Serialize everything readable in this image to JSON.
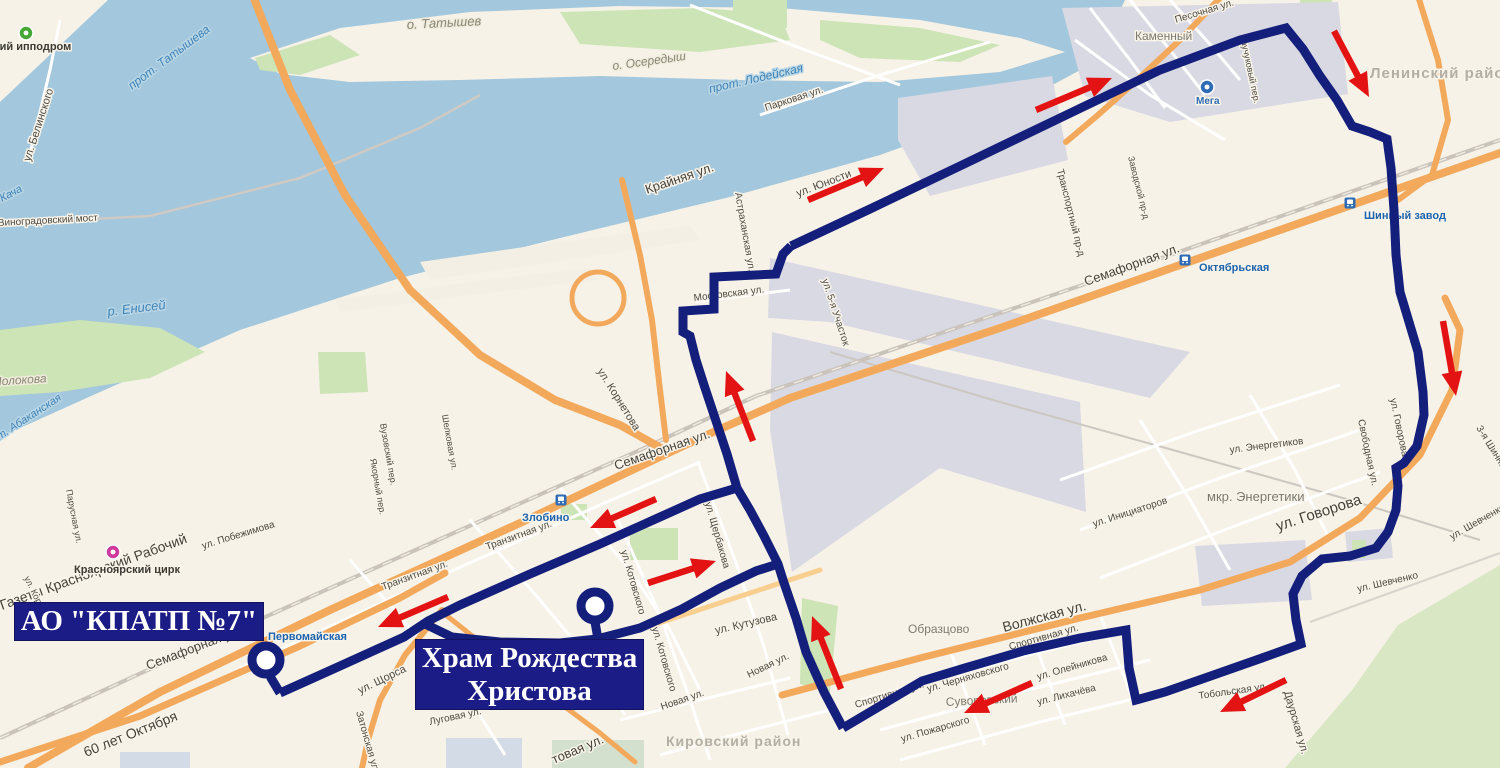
{
  "map": {
    "colors": {
      "background": "#f7f2e8",
      "water": "#a3c7dc",
      "green": "#cde4b6",
      "industrial": "#d9d9e3",
      "main_road": "#f3a95c",
      "route": "#141f7b",
      "arrow": "#e31313",
      "callout_bg": "#1c1c87",
      "station_blue": "#2e6cb6"
    },
    "callouts": [
      {
        "id": "depot",
        "text": "АО \"КПАТП №7\""
      },
      {
        "id": "khram",
        "lines": [
          "Храм Рождества",
          "Христова"
        ]
      }
    ],
    "terminals": [
      {
        "name": "АО КПАТП №7",
        "x": 266,
        "y": 660
      },
      {
        "name": "Храм Рождества Христова",
        "x": 595,
        "y": 606
      }
    ],
    "route": {
      "width": 9,
      "segments": [
        [
          [
            267,
            661
          ],
          [
            271,
            678
          ],
          [
            280,
            693
          ]
        ],
        [
          [
            280,
            693
          ],
          [
            340,
            666
          ],
          [
            404,
            637
          ],
          [
            428,
            621
          ],
          [
            460,
            605
          ],
          [
            530,
            574
          ],
          [
            600,
            544
          ],
          [
            660,
            517
          ],
          [
            700,
            499
          ],
          [
            737,
            488
          ]
        ],
        [
          [
            425,
            624
          ],
          [
            452,
            637
          ],
          [
            500,
            642
          ],
          [
            560,
            643
          ],
          [
            597,
            639
          ],
          [
            640,
            628
          ],
          [
            682,
            609
          ],
          [
            720,
            588
          ],
          [
            756,
            571
          ],
          [
            778,
            564
          ]
        ],
        [
          [
            595,
            622
          ],
          [
            598,
            639
          ]
        ],
        [
          [
            843,
            728
          ],
          [
            824,
            692
          ],
          [
            806,
            652
          ],
          [
            796,
            618
          ],
          [
            783,
            580
          ],
          [
            778,
            564
          ],
          [
            764,
            536
          ],
          [
            750,
            510
          ],
          [
            737,
            488
          ],
          [
            727,
            454
          ],
          [
            716,
            421
          ],
          [
            705,
            388
          ],
          [
            696,
            360
          ],
          [
            690,
            336
          ],
          [
            683,
            332
          ],
          [
            683,
            311
          ],
          [
            714,
            309
          ],
          [
            714,
            277
          ],
          [
            776,
            274
          ],
          [
            783,
            254
          ],
          [
            791,
            246
          ]
        ],
        [
          [
            791,
            246
          ],
          [
            870,
            209
          ],
          [
            960,
            166
          ],
          [
            1060,
            118
          ],
          [
            1160,
            70
          ],
          [
            1240,
            40
          ],
          [
            1286,
            28
          ],
          [
            1303,
            49
          ],
          [
            1320,
            76
          ],
          [
            1337,
            100
          ],
          [
            1352,
            126
          ],
          [
            1370,
            132
          ],
          [
            1387,
            139
          ],
          [
            1391,
            168
          ],
          [
            1394,
            210
          ],
          [
            1396,
            255
          ],
          [
            1400,
            292
          ],
          [
            1409,
            322
          ],
          [
            1418,
            352
          ],
          [
            1423,
            392
          ],
          [
            1424,
            415
          ],
          [
            1417,
            446
          ],
          [
            1404,
            463
          ],
          [
            1396,
            468
          ],
          [
            1398,
            486
          ],
          [
            1396,
            510
          ],
          [
            1388,
            532
          ],
          [
            1376,
            548
          ],
          [
            1350,
            556
          ],
          [
            1322,
            559
          ],
          [
            1302,
            576
          ],
          [
            1293,
            594
          ],
          [
            1296,
            620
          ],
          [
            1301,
            644
          ],
          [
            1262,
            658
          ],
          [
            1205,
            678
          ],
          [
            1165,
            692
          ],
          [
            1136,
            700
          ],
          [
            1129,
            668
          ],
          [
            1126,
            630
          ],
          [
            1080,
            638
          ],
          [
            1023,
            651
          ],
          [
            965,
            668
          ],
          [
            922,
            681
          ],
          [
            870,
            712
          ],
          [
            843,
            728
          ]
        ]
      ]
    },
    "arrows": [
      [
        808,
        200,
        884,
        168
      ],
      [
        1036,
        110,
        1112,
        78
      ],
      [
        1334,
        31,
        1369,
        97
      ],
      [
        1443,
        321,
        1456,
        396
      ],
      [
        753,
        441,
        726,
        371
      ],
      [
        841,
        689,
        812,
        616
      ],
      [
        656,
        499,
        590,
        528
      ],
      [
        448,
        597,
        378,
        627
      ],
      [
        648,
        583,
        716,
        561
      ],
      [
        1032,
        683,
        964,
        713
      ],
      [
        1286,
        680,
        1220,
        712
      ]
    ],
    "stations": [
      {
        "name": "Первомайская",
        "x": 254,
        "y": 628,
        "tx": 268,
        "ty": 640
      },
      {
        "name": "Злобино",
        "x": 561,
        "y": 500,
        "tx": 522,
        "ty": 521
      },
      {
        "name": "Октябрьская",
        "x": 1185,
        "y": 260,
        "tx": 1199,
        "ty": 271
      },
      {
        "name": "Шинный завод",
        "x": 1350,
        "y": 203,
        "tx": 1364,
        "ty": 219
      }
    ],
    "pois": [
      {
        "name": "ипподром",
        "x": 26,
        "y": 33,
        "color": "#45a836"
      },
      {
        "name": "цирк",
        "x": 113,
        "y": 552,
        "color": "#cf3a9b"
      },
      {
        "name": "Мега",
        "x": 1207,
        "y": 87,
        "color": "#2e6cb6"
      }
    ],
    "labels": [
      {
        "t": "Красноярский ипподром",
        "x": -64,
        "y": 50,
        "r": 0,
        "s": 11,
        "c": "poi"
      },
      {
        "t": "ул. Белинского",
        "x": 30,
        "y": 162,
        "r": -72,
        "s": 11,
        "c": "st"
      },
      {
        "t": "прот. Татышева",
        "x": 132,
        "y": 90,
        "r": -37,
        "s": 12,
        "c": "w"
      },
      {
        "t": "о. Татышев",
        "x": 407,
        "y": 29,
        "r": -3,
        "s": 13,
        "c": "li"
      },
      {
        "t": "о. Осередыш",
        "x": 613,
        "y": 70,
        "r": -8,
        "s": 12,
        "c": "li"
      },
      {
        "t": "прот. Лодейская",
        "x": 710,
        "y": 93,
        "r": -13,
        "s": 12,
        "c": "w"
      },
      {
        "t": "Парковая ул.",
        "x": 766,
        "y": 111,
        "r": -18,
        "s": 10,
        "c": "st"
      },
      {
        "t": "Крайняя ул.",
        "x": 647,
        "y": 194,
        "r": -19,
        "s": 13,
        "c": "stb"
      },
      {
        "t": "Астраханская ул.",
        "x": 735,
        "y": 193,
        "r": 80,
        "s": 10,
        "c": "st"
      },
      {
        "t": "ул. Юности",
        "x": 798,
        "y": 197,
        "r": -21,
        "s": 11,
        "c": "st"
      },
      {
        "t": "Песочная ул.",
        "x": 1176,
        "y": 23,
        "r": -17,
        "s": 10,
        "c": "st"
      },
      {
        "t": "Каменный",
        "x": 1135,
        "y": 40,
        "r": 0,
        "s": 12,
        "c": "d"
      },
      {
        "t": "Мега",
        "x": 1196,
        "y": 104,
        "r": 0,
        "s": 10,
        "c": "mega"
      },
      {
        "t": "Каучуковый пер.",
        "x": 1240,
        "y": 36,
        "r": 78,
        "s": 9,
        "c": "st"
      },
      {
        "t": "Ленинский район",
        "x": 1370,
        "y": 78,
        "r": 0,
        "s": 15,
        "c": "db"
      },
      {
        "t": "Транспортный пр-д",
        "x": 1057,
        "y": 170,
        "r": 76,
        "s": 10,
        "c": "st"
      },
      {
        "t": "Заводской пр-д",
        "x": 1128,
        "y": 157,
        "r": 76,
        "s": 9,
        "c": "st"
      },
      {
        "t": "Семафорная ул.",
        "x": 1086,
        "y": 286,
        "r": -20,
        "s": 13,
        "c": "stb"
      },
      {
        "t": "Московская ул.",
        "x": 694,
        "y": 301,
        "r": -7,
        "s": 10,
        "c": "st"
      },
      {
        "t": "ул. 5-я Участок",
        "x": 822,
        "y": 280,
        "r": 72,
        "s": 10,
        "c": "st"
      },
      {
        "t": "ул. Корнетова",
        "x": 597,
        "y": 371,
        "r": 58,
        "s": 11,
        "c": "st"
      },
      {
        "t": "Семафорная ул.",
        "x": 616,
        "y": 470,
        "r": -19,
        "s": 13,
        "c": "stb"
      },
      {
        "t": "р. Енисей",
        "x": 108,
        "y": 316,
        "r": -7,
        "s": 13,
        "c": "w"
      },
      {
        "t": "Молокова",
        "x": -8,
        "y": 386,
        "r": -4,
        "s": 12,
        "c": "li"
      },
      {
        "t": "прот. Абаканская",
        "x": -16,
        "y": 450,
        "r": -33,
        "s": 11,
        "c": "w"
      },
      {
        "t": "Парусная ул.",
        "x": 66,
        "y": 490,
        "r": 79,
        "s": 9,
        "c": "st"
      },
      {
        "t": "Газеты Красноярский Рабочий",
        "x": 2,
        "y": 610,
        "r": -20,
        "s": 14,
        "c": "stb"
      },
      {
        "t": "ул. Побежимова",
        "x": 203,
        "y": 549,
        "r": -17,
        "s": 10,
        "c": "st"
      },
      {
        "t": "Красноярский цирк",
        "x": 74,
        "y": 573,
        "r": 0,
        "s": 11,
        "c": "poi"
      },
      {
        "t": "ул. Королёва",
        "x": 24,
        "y": 578,
        "r": 64,
        "s": 9,
        "c": "st"
      },
      {
        "t": "Вузовский пер.",
        "x": 380,
        "y": 424,
        "r": 80,
        "s": 9,
        "c": "st"
      },
      {
        "t": "Якорный пер.",
        "x": 370,
        "y": 459,
        "r": 80,
        "s": 9,
        "c": "st"
      },
      {
        "t": "Шелковая ул.",
        "x": 442,
        "y": 415,
        "r": 80,
        "s": 9,
        "c": "st"
      },
      {
        "t": "Семафорная ул.",
        "x": 148,
        "y": 670,
        "r": -21,
        "s": 13,
        "c": "stb"
      },
      {
        "t": "Транзитная ул.",
        "x": 383,
        "y": 590,
        "r": -20,
        "s": 10,
        "c": "st"
      },
      {
        "t": "Транзитная ул.",
        "x": 487,
        "y": 550,
        "r": -20,
        "s": 10,
        "c": "st"
      },
      {
        "t": "ул. Щорса",
        "x": 360,
        "y": 694,
        "r": -26,
        "s": 11,
        "c": "st"
      },
      {
        "t": "Затонская ул.",
        "x": 356,
        "y": 712,
        "r": 74,
        "s": 10,
        "c": "st"
      },
      {
        "t": "60 лет Октября",
        "x": 86,
        "y": 757,
        "r": -22,
        "s": 14,
        "c": "stb"
      },
      {
        "t": "Луговая ул.",
        "x": 430,
        "y": 725,
        "r": -12,
        "s": 10,
        "c": "st"
      },
      {
        "t": "ул. Щербакова",
        "x": 705,
        "y": 503,
        "r": 74,
        "s": 10,
        "c": "st"
      },
      {
        "t": "ул. Котовского",
        "x": 621,
        "y": 551,
        "r": 74,
        "s": 10,
        "c": "st"
      },
      {
        "t": "ул. Котовского",
        "x": 652,
        "y": 628,
        "r": 74,
        "s": 10,
        "c": "st"
      },
      {
        "t": "ул. Кутузова",
        "x": 716,
        "y": 634,
        "r": -13,
        "s": 11,
        "c": "st"
      },
      {
        "t": "Новая ул.",
        "x": 749,
        "y": 678,
        "r": -26,
        "s": 10,
        "c": "st"
      },
      {
        "t": "Новая ул.",
        "x": 662,
        "y": 710,
        "r": -19,
        "s": 10,
        "c": "st"
      },
      {
        "t": "Кировский район",
        "x": 666,
        "y": 746,
        "r": 0,
        "s": 14,
        "c": "db"
      },
      {
        "t": "товая ул.",
        "x": 554,
        "y": 764,
        "r": -23,
        "s": 13,
        "c": "stb"
      },
      {
        "t": "Образцово",
        "x": 908,
        "y": 633,
        "r": 0,
        "s": 12,
        "c": "d"
      },
      {
        "t": "Волжская ул.",
        "x": 1004,
        "y": 632,
        "r": -15,
        "s": 14,
        "c": "stb"
      },
      {
        "t": "Спортивная ул.",
        "x": 1010,
        "y": 650,
        "r": -16,
        "s": 10,
        "c": "st"
      },
      {
        "t": "Спортивная ул.",
        "x": 856,
        "y": 708,
        "r": -17,
        "s": 10,
        "c": "st"
      },
      {
        "t": "ул. Черняховского",
        "x": 928,
        "y": 692,
        "r": -16,
        "s": 10,
        "c": "st"
      },
      {
        "t": "ул. Олейникова",
        "x": 1038,
        "y": 680,
        "r": -16,
        "s": 10,
        "c": "st"
      },
      {
        "t": "ул. Лихачёва",
        "x": 1038,
        "y": 705,
        "r": -14,
        "s": 10,
        "c": "st"
      },
      {
        "t": "ул. Пожарского",
        "x": 902,
        "y": 742,
        "r": -16,
        "s": 10,
        "c": "st"
      },
      {
        "t": "Суворовский",
        "x": 946,
        "y": 706,
        "r": -3,
        "s": 12,
        "c": "d"
      },
      {
        "t": "ул. Инициаторов",
        "x": 1094,
        "y": 527,
        "r": -18,
        "s": 10,
        "c": "st"
      },
      {
        "t": "мкр. Энергетики",
        "x": 1207,
        "y": 501,
        "r": 0,
        "s": 13,
        "c": "d"
      },
      {
        "t": "ул. Энергетиков",
        "x": 1230,
        "y": 453,
        "r": -7,
        "s": 10,
        "c": "st"
      },
      {
        "t": "Свободная ул.",
        "x": 1358,
        "y": 420,
        "r": 78,
        "s": 10,
        "c": "st"
      },
      {
        "t": "ул. Говорова",
        "x": 1390,
        "y": 399,
        "r": 78,
        "s": 10,
        "c": "st"
      },
      {
        "t": "ул. Говорова",
        "x": 1278,
        "y": 531,
        "r": -18,
        "s": 15,
        "c": "stb"
      },
      {
        "t": "3-я Шинная",
        "x": 1476,
        "y": 428,
        "r": 58,
        "s": 10,
        "c": "st"
      },
      {
        "t": "ул. Шевченко",
        "x": 1358,
        "y": 592,
        "r": -13,
        "s": 10,
        "c": "st"
      },
      {
        "t": "ул. Шевченко",
        "x": 1452,
        "y": 540,
        "r": -30,
        "s": 10,
        "c": "st"
      },
      {
        "t": "Даурская ул.",
        "x": 1284,
        "y": 692,
        "r": 74,
        "s": 11,
        "c": "st"
      },
      {
        "t": "Тобольская ул.",
        "x": 1199,
        "y": 699,
        "r": -8,
        "s": 10,
        "c": "st"
      },
      {
        "t": "Виноградовский мост",
        "x": -2,
        "y": 226,
        "r": -3,
        "s": 10,
        "c": "st"
      },
      {
        "t": "Кача",
        "x": 2,
        "y": 202,
        "r": -28,
        "s": 11,
        "c": "w"
      }
    ]
  }
}
